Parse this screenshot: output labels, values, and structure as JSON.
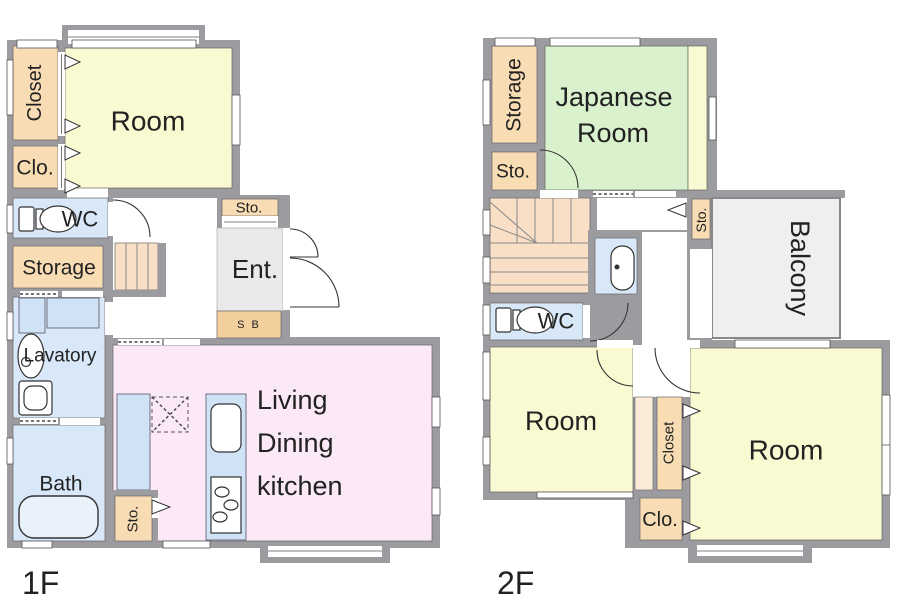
{
  "plan_title": "House floor plan",
  "floors": {
    "f1": {
      "label": "1F",
      "rooms": {
        "closet": "Closet",
        "clo": "Clo.",
        "room": "Room",
        "wc": "WC",
        "storage": "Storage",
        "lavatory": "Lavatory",
        "bath": "Bath",
        "sto_bath": "Sto.",
        "sto_ent": "Sto.",
        "shoe_box": "S B",
        "ent": "Ent.",
        "ldk_line1": "Living",
        "ldk_line2": "Dining",
        "ldk_line3": "kitchen"
      }
    },
    "f2": {
      "label": "2F",
      "rooms": {
        "storage": "Storage",
        "sto_upper": "Sto.",
        "japanese_line1": "Japanese",
        "japanese_line2": "Room",
        "sto_hall": "Sto.",
        "balcony": "Balcony",
        "wc": "WC",
        "room_left": "Room",
        "room_right": "Room",
        "closet": "Closet",
        "clo": "Clo."
      }
    }
  },
  "colors": {
    "wall": "#9c9ca0",
    "room_yellow": "#fafad2",
    "closet_peach": "#f8ddb4",
    "closet_light": "#faecd9",
    "wet_blue": "#d8e8f8",
    "counter_blue": "#cfe2f6",
    "ldk_pink": "#fbe9f8",
    "tatami_green": "#daf1cd",
    "balcony_gray": "#efefef",
    "entrance_gray": "#e9e9e9",
    "stairs": "#f8dfc6",
    "sb_peach": "#f4cf9e"
  }
}
